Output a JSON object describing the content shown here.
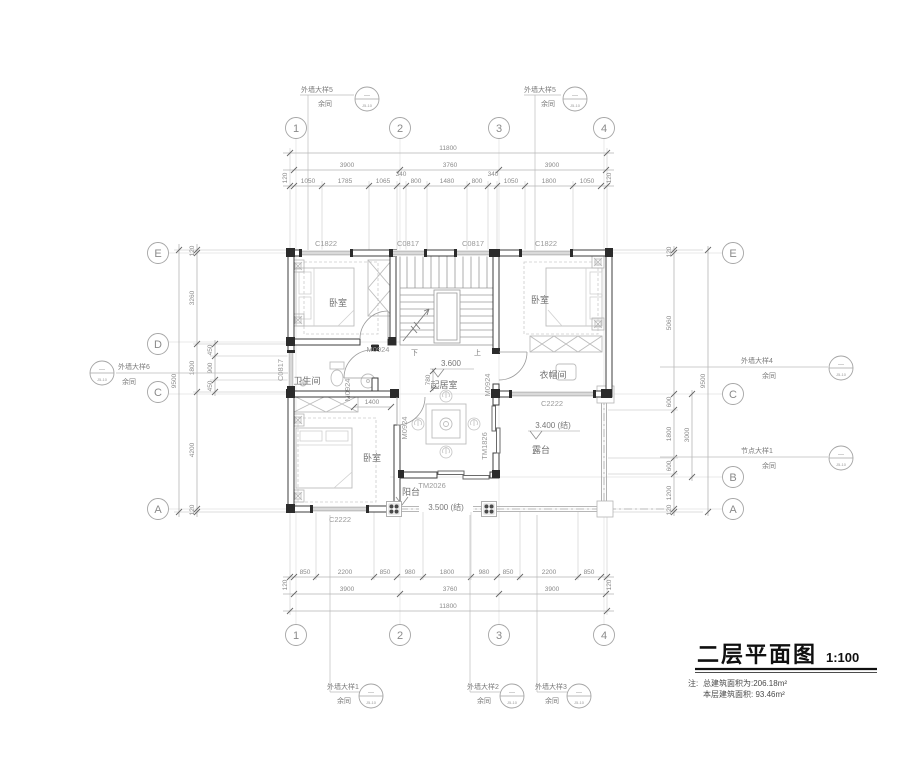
{
  "title": {
    "text": "二层平面图",
    "scale": "1:100"
  },
  "notes": {
    "prefix": "注:",
    "line1": "总建筑面积为:206.18m²",
    "line2": "本层建筑面积: 93.46m²"
  },
  "grid": {
    "cols": [
      "1",
      "2",
      "3",
      "4"
    ],
    "left_rows": [
      "E",
      "D",
      "C",
      "A"
    ],
    "right_rows": [
      "E",
      "C",
      "B",
      "A"
    ]
  },
  "dims": {
    "top": {
      "total": "11800",
      "spans": [
        "3900",
        "3760",
        "3900"
      ],
      "detail": [
        "1050",
        "1785",
        "1065",
        "340",
        "800",
        "1480",
        "800",
        "340",
        "1050",
        "1800",
        "1050"
      ],
      "edge": "120"
    },
    "bottom": {
      "total": "11800",
      "spans": [
        "3900",
        "3760",
        "3900"
      ],
      "detail": [
        "850",
        "2200",
        "850",
        "980",
        "1800",
        "980",
        "850",
        "2200",
        "850"
      ],
      "edge": "120"
    },
    "left": {
      "total": "9500",
      "detail": [
        "120",
        "3260",
        "1800",
        "4200",
        "120"
      ],
      "inner": [
        "450",
        "900",
        "450"
      ]
    },
    "right": {
      "total": "9500",
      "span": "3000",
      "detail": [
        "120",
        "5060",
        "600",
        "1800",
        "600",
        "1200",
        "120"
      ]
    },
    "inner": {
      "living_w": "780",
      "door_off": "1400"
    }
  },
  "rooms": {
    "bedroom1": "卧室",
    "bedroom2": "卧室",
    "bedroom3": "卧室",
    "bathroom": "卫生间",
    "living": "起居室",
    "cloakroom": "衣帽间",
    "terrace": "露台",
    "balcony": "阳台"
  },
  "levels": {
    "living": "3.600",
    "terrace": "3.400 (结)",
    "balcony": "3.500 (结)"
  },
  "stairs": {
    "down": "下",
    "up": "上"
  },
  "openings": {
    "c1822": "C1822",
    "c0817": "C0817",
    "c2222": "C2222",
    "m0924": "M0924",
    "tm1826": "TM1826",
    "tm2026": "TM2026"
  },
  "callouts": {
    "w1": "外墙大样1",
    "w2": "外墙大样2",
    "w3": "外墙大样3",
    "w4": "外墙大样4",
    "w5": "外墙大样5",
    "w6": "外墙大样6",
    "node1": "节点大样1",
    "repeat": "余同",
    "ref_top": "—",
    "ref_bottom": "J5-10"
  }
}
